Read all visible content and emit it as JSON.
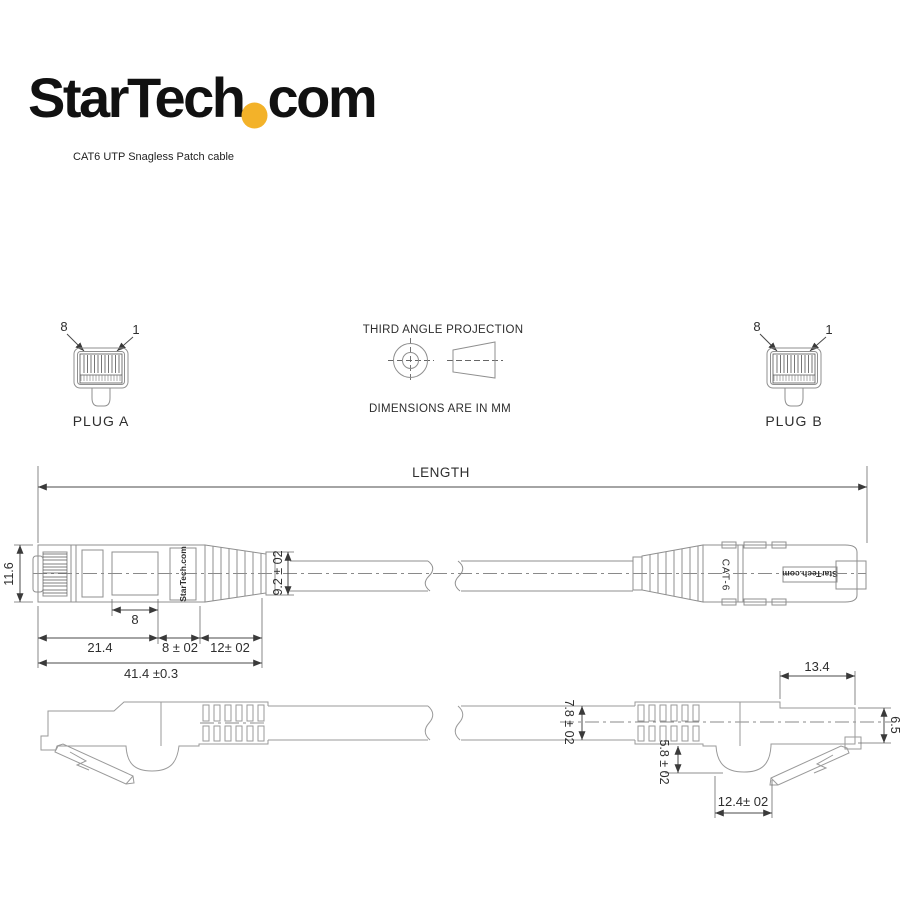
{
  "logo": {
    "text_main": "StarTech",
    "text_suffix": "com",
    "dot_color": "#F3B229"
  },
  "subtitle": "CAT6 UTP Snagless Patch cable",
  "projection": {
    "title": "THIRD ANGLE PROJECTION",
    "units_note": "DIMENSIONS ARE IN MM"
  },
  "plug_a": {
    "label": "PLUG A",
    "pin_left": "8",
    "pin_right": "1"
  },
  "plug_b": {
    "label": "PLUG B",
    "pin_left": "8",
    "pin_right": "1"
  },
  "length_label": "LENGTH",
  "side_view": {
    "overall_height": "11.6",
    "boot_height": "9.2 ± 02",
    "window_width": "8",
    "body_length": "21.4",
    "mid_length": "8 ± 02",
    "boot_length": "12± 02",
    "total_length": "41.4 ±0.3",
    "brand_left": "StarTech.com",
    "brand_right": "StarTech.com",
    "category_label": "CAT-6"
  },
  "bottom_view": {
    "cable_diameter": "7.8 ± 02",
    "latch_depth": "5.8 ± 02",
    "latch_width": "12.4± 02",
    "tip_length": "13.4",
    "tip_height": "6.5"
  }
}
